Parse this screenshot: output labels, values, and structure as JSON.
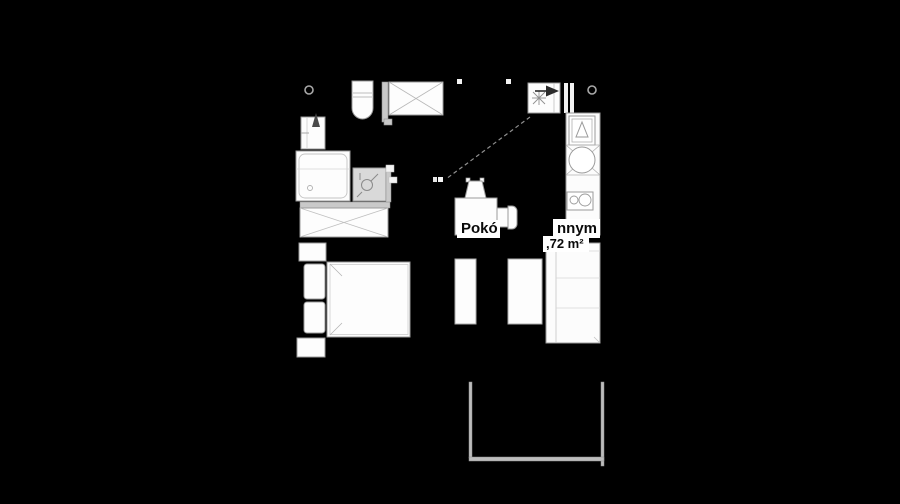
{
  "plan": {
    "room_label_visible_start": "Pokó",
    "room_label_visible_end": "nnym",
    "area_label": ",72 m²"
  },
  "colors": {
    "background": "#000000",
    "line": "#9a9a9a",
    "line_light": "#c4c4c4",
    "fill": "#fdfdfd",
    "wall_fill": "#c9c9c9",
    "label_text": "#0a0a0a",
    "label_background": "#ffffff"
  },
  "fixtures": [
    "toilet",
    "crossed-cabinet",
    "water-heater",
    "radiator-cabinet",
    "shower-tray",
    "washbasin",
    "washing-machine",
    "fridge",
    "round-sink",
    "hob-two-burner",
    "armchair",
    "double-bed",
    "pillows",
    "nightstands",
    "cabinets",
    "sofa",
    "balcony"
  ]
}
